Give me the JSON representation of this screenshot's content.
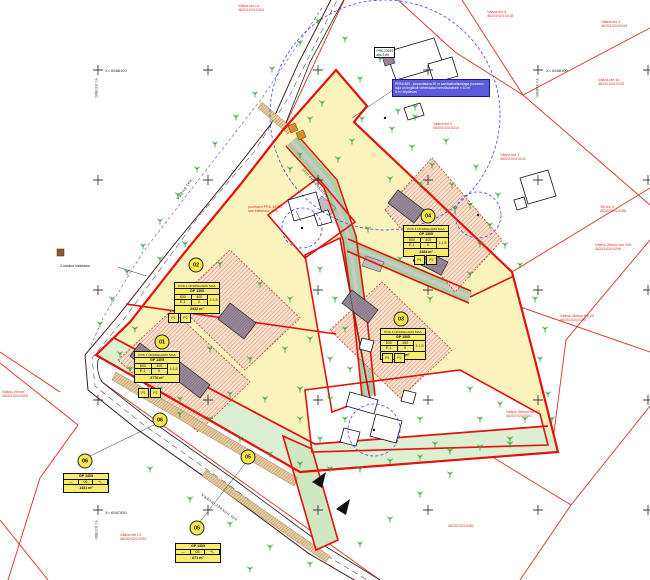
{
  "map": {
    "plan_number": "GP 1305",
    "legend_note": {
      "lines": [
        "PRK6 860 - kavandatava 50 m sanitaarkaitsealaga puurkaev,",
        "kuja on tinglikult vähendatud veevõtukohani r=10 m",
        "5 m³ ööpäevas"
      ]
    },
    "well_label": {
      "lines": [
        "PRK-22645",
        "abs 9,80"
      ]
    }
  },
  "colors": {
    "site_yellow": "#FAF3BC",
    "strip_green": "#DCEFD2",
    "drive_green": "#A9CFA0",
    "envelope_peach": "#F8E2CC",
    "hatch_red": "#C8503C",
    "boundary_red": "#E3120B",
    "thin_red": "#D93025",
    "building_gray": "#9C8C9C",
    "tree_green": "#2FA12F",
    "well_blue": "#4646E8",
    "legend_blue": "#5B5BD8",
    "berm_brown": "#8A5A2B",
    "road_black": "#222222"
  },
  "pos_tables": [
    {
      "id": "01",
      "small": false,
      "circle": {
        "x": 162,
        "y": 342
      },
      "table": {
        "x": 134,
        "y": 351
      },
      "title": "POS 1 ÜKSIKELAMU MAA",
      "plan": "GP 1305",
      "c1": "600",
      "c2": "400",
      "c3": "E,1",
      "c4": "II",
      "ratio": "1:1,5",
      "area": "2770 m²",
      "parking": [
        "P1",
        "P2"
      ],
      "parking_pos": {
        "x": 138,
        "y": 388
      }
    },
    {
      "id": "02",
      "small": false,
      "circle": {
        "x": 196,
        "y": 265
      },
      "table": {
        "x": 174,
        "y": 282
      },
      "title": "POS 2 ÜKSIKELAMU MAA",
      "plan": "GP 1305",
      "c1": "600",
      "c2": "400",
      "c3": "E,1",
      "c4": "II",
      "ratio": "1:1,5",
      "area": "2922 m²",
      "parking": [
        "P1",
        "P2"
      ],
      "parking_pos": {
        "x": 168,
        "y": 313
      }
    },
    {
      "id": "03",
      "small": false,
      "circle": {
        "x": 401,
        "y": 319
      },
      "table": {
        "x": 380,
        "y": 328
      },
      "title": "POS 3 ÜKSIKELAMU MAA",
      "plan": "GP 1305",
      "c1": "500",
      "c2": "400",
      "c3": "E,1",
      "c4": "II",
      "ratio": "1:1,5",
      "area": "2811 m²",
      "parking": [
        "P1",
        "P2"
      ],
      "parking_pos": {
        "x": 382,
        "y": 353
      }
    },
    {
      "id": "04",
      "small": false,
      "circle": {
        "x": 428,
        "y": 216
      },
      "table": {
        "x": 403,
        "y": 225
      },
      "title": "POS 4 ÜKSIKELAMU MAA",
      "plan": "GP 1305",
      "c1": "500",
      "c2": "400",
      "c3": "E,1",
      "c4": "II",
      "ratio": "1:1,5",
      "area": "2484 m²",
      "parking": [
        "P1",
        "P2"
      ],
      "parking_pos": {
        "x": 414,
        "y": 255
      }
    },
    {
      "id": "06",
      "small": true,
      "circle": {
        "x": 85,
        "y": 461
      },
      "table": {
        "x": 63,
        "y": 473
      },
      "plan": "GP 1305",
      "r1": "—",
      "r2": "06",
      "r3": "+/-",
      "area": "1431 m²"
    },
    {
      "id": "05",
      "small": true,
      "circle": {
        "x": 197,
        "y": 528
      },
      "table": {
        "x": 175,
        "y": 543
      },
      "plan": "GP 1305",
      "r1": "—",
      "r2": "05",
      "r3": "+/-",
      "area": "671 m²"
    }
  ],
  "strip_markers": [
    {
      "label": "06",
      "x": 160,
      "y": 420
    },
    {
      "label": "05",
      "x": 248,
      "y": 457
    }
  ],
  "map_labels": [
    {
      "lines": [
        "Vääna tee L6",
        "46203:024:0254"
      ],
      "x": 238,
      "y": 4,
      "color": "red"
    },
    {
      "lines": [
        "Vääna tee 8",
        "46203:024:0218"
      ],
      "x": 487,
      "y": 10,
      "color": "red"
    },
    {
      "lines": [
        "Vääna tee 4",
        "46203:024:0244"
      ],
      "x": 601,
      "y": 20,
      "color": "red"
    },
    {
      "lines": [
        "Vääna tee 4a",
        "46203:024:0245"
      ],
      "x": 598,
      "y": 78,
      "color": "red"
    },
    {
      "lines": [
        "Vääna tee 5",
        "46203:024:0210"
      ],
      "x": 433,
      "y": 122,
      "color": "red"
    },
    {
      "lines": [
        "Vääna tee 7",
        "46203:024:0211"
      ],
      "x": 500,
      "y": 153,
      "color": "red"
    },
    {
      "lines": [
        "Viti tee 3",
        "46203:024:0158"
      ],
      "x": 600,
      "y": 205,
      "color": "red"
    },
    {
      "lines": [
        "Vääna-Jõesuu tee 29a",
        "46203:024:0296"
      ],
      "x": 595,
      "y": 243,
      "color": "red"
    },
    {
      "lines": [
        "Vääna-Jõesuu tee 29",
        "46203:024:0295"
      ],
      "x": 560,
      "y": 314,
      "color": "red"
    },
    {
      "lines": [
        "Vääna-Jõesuu tee 30",
        "46203:024:0301"
      ],
      "x": 506,
      "y": 410,
      "color": "red"
    },
    {
      "lines": [
        "46203:024:0262"
      ],
      "x": 448,
      "y": 524,
      "color": "red"
    },
    {
      "lines": [
        "Vääna tee L5",
        "46203:024:0253"
      ],
      "x": 120,
      "y": 533,
      "color": "red"
    },
    {
      "lines": [
        "Vääna-Viti tee",
        "46203:024:0005"
      ],
      "x": 2,
      "y": 390,
      "color": "red"
    },
    {
      "lines": [
        "puurkaev PRK-14553",
        "san.kaitseala 10 m"
      ],
      "x": 248,
      "y": 205,
      "color": "red"
    },
    {
      "lines": [
        "2-kordne kivielamu"
      ],
      "x": 60,
      "y": 264,
      "color": "black"
    }
  ],
  "street_labels": [
    {
      "text": "Vääna tee",
      "x": 175,
      "y": 198,
      "rot": -55
    },
    {
      "text": "Vääna-Jõesuu tee",
      "x": 203,
      "y": 492,
      "rot": 36
    },
    {
      "text": "juurdepääsutee",
      "x": 305,
      "y": 167,
      "rot": 49
    }
  ],
  "grid": {
    "xs": [
      98,
      208,
      318,
      428,
      538,
      648
    ],
    "ys": [
      70,
      180,
      290,
      400,
      510
    ],
    "coord_labels": [
      {
        "x": 98,
        "y": 70,
        "x_text": "X= 6588100",
        "y_text": "Y= 537800"
      },
      {
        "x": 539,
        "y": 70,
        "x_text": "X= 6588100",
        "y_text": "Y= 538300"
      },
      {
        "x": 98,
        "y": 512,
        "x_text": "X= 6587650",
        "y_text": "Y= 537800"
      }
    ]
  },
  "trees": [
    [
      318,
      22
    ],
    [
      300,
      44
    ],
    [
      272,
      70
    ],
    [
      255,
      95
    ],
    [
      236,
      118
    ],
    [
      215,
      145
    ],
    [
      197,
      170
    ],
    [
      178,
      196
    ],
    [
      160,
      222
    ],
    [
      143,
      247
    ],
    [
      127,
      273
    ],
    [
      112,
      300
    ],
    [
      100,
      325
    ],
    [
      392,
      130
    ],
    [
      412,
      148
    ],
    [
      432,
      166
    ],
    [
      452,
      186
    ],
    [
      470,
      206
    ],
    [
      490,
      226
    ],
    [
      505,
      246
    ],
    [
      520,
      266
    ],
    [
      535,
      300
    ],
    [
      545,
      330
    ],
    [
      540,
      360
    ],
    [
      548,
      395
    ],
    [
      552,
      420
    ],
    [
      415,
      118
    ],
    [
      446,
      142
    ],
    [
      476,
      168
    ],
    [
      498,
      196
    ],
    [
      362,
      120
    ],
    [
      352,
      142
    ],
    [
      338,
      160
    ],
    [
      310,
      120
    ],
    [
      322,
      104
    ],
    [
      300,
      156
    ],
    [
      290,
      170
    ],
    [
      390,
      180
    ],
    [
      420,
      185
    ],
    [
      455,
      210
    ],
    [
      480,
      245
    ],
    [
      470,
      275
    ],
    [
      430,
      300
    ],
    [
      400,
      260
    ],
    [
      368,
      230
    ],
    [
      160,
      260
    ],
    [
      185,
      245
    ],
    [
      220,
      265
    ],
    [
      260,
      285
    ],
    [
      290,
      300
    ],
    [
      135,
      330
    ],
    [
      160,
      390
    ],
    [
      130,
      370
    ],
    [
      210,
      350
    ],
    [
      250,
      360
    ],
    [
      285,
      350
    ],
    [
      230,
      395
    ],
    [
      265,
      400
    ],
    [
      300,
      390
    ],
    [
      180,
      415
    ],
    [
      320,
      270
    ],
    [
      335,
      300
    ],
    [
      345,
      330
    ],
    [
      330,
      360
    ],
    [
      350,
      370
    ],
    [
      310,
      340
    ],
    [
      330,
      400
    ],
    [
      345,
      420
    ],
    [
      420,
      420
    ],
    [
      435,
      445
    ],
    [
      320,
      440
    ],
    [
      300,
      420
    ],
    [
      470,
      390
    ],
    [
      500,
      405
    ],
    [
      525,
      420
    ],
    [
      480,
      420
    ],
    [
      510,
      440
    ],
    [
      120,
      355
    ],
    [
      150,
      380
    ],
    [
      180,
      400
    ],
    [
      210,
      420
    ],
    [
      240,
      440
    ],
    [
      270,
      455
    ],
    [
      300,
      465
    ],
    [
      330,
      470
    ],
    [
      360,
      470
    ],
    [
      390,
      462
    ],
    [
      420,
      458
    ],
    [
      450,
      452
    ],
    [
      480,
      448
    ],
    [
      510,
      445
    ],
    [
      150,
      470
    ],
    [
      190,
      500
    ],
    [
      230,
      525
    ],
    [
      270,
      548
    ],
    [
      310,
      565
    ],
    [
      360,
      545
    ],
    [
      390,
      520
    ],
    [
      420,
      495
    ],
    [
      450,
      475
    ],
    [
      250,
      570
    ],
    [
      210,
      555
    ],
    [
      380,
      60
    ],
    [
      360,
      80
    ],
    [
      345,
      40
    ],
    [
      398,
      112
    ],
    [
      415,
      108
    ]
  ]
}
